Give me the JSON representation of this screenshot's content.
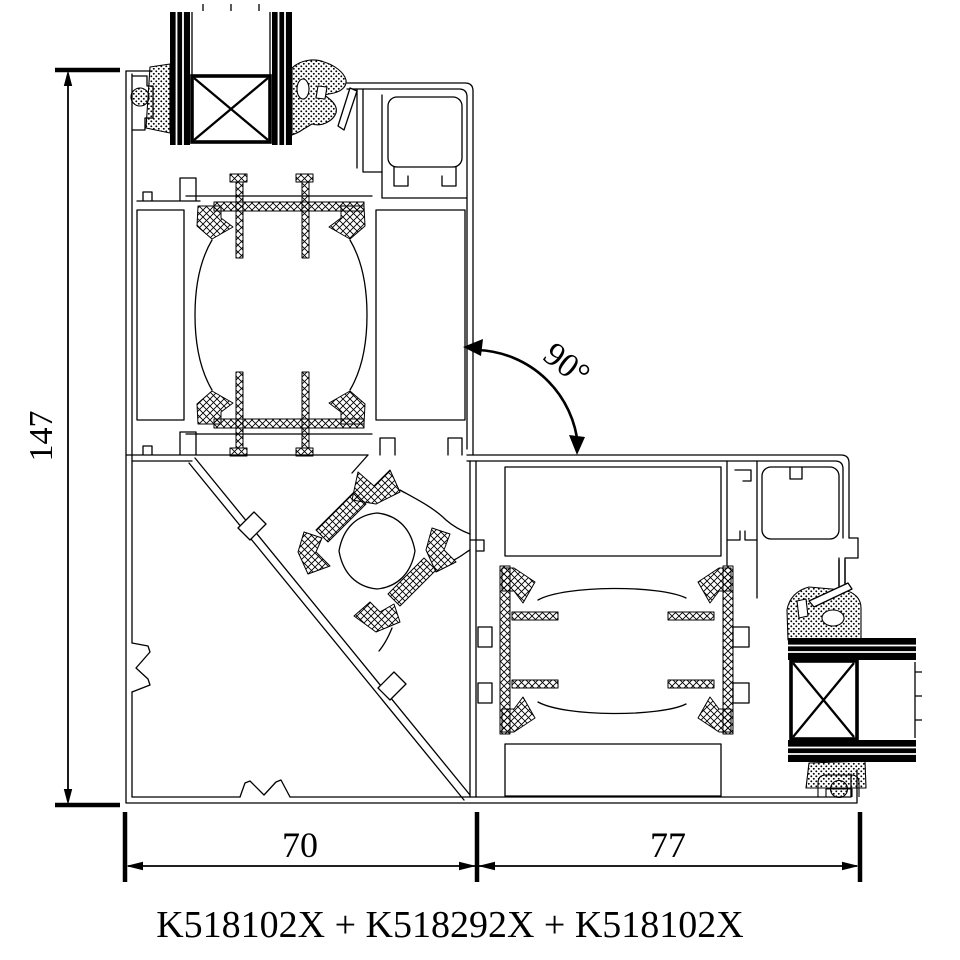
{
  "drawing": {
    "caption": "K518102X + K518292X + K518102X",
    "angle_label": "90°",
    "dimensions": {
      "height": "147",
      "width_left": "70",
      "width_right": "77"
    },
    "colors": {
      "line": "#000000",
      "background": "#ffffff"
    }
  }
}
